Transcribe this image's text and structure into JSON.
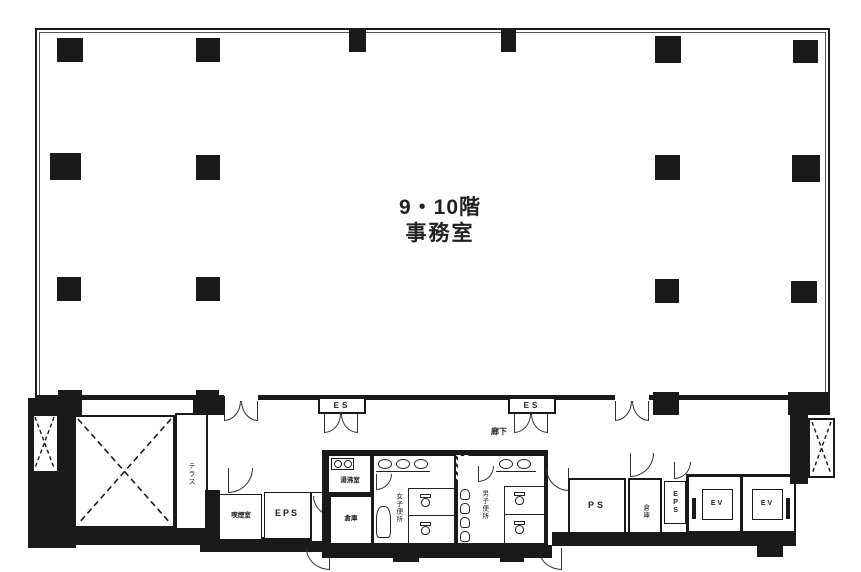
{
  "title": {
    "line1": "9・10階",
    "line2": "事務室"
  },
  "labels": {
    "es_left": "ES",
    "es_right": "ES",
    "corridor": "廊下",
    "terrace": "テラス",
    "smoking_room": "喫煙室",
    "eps_left": "EPS",
    "kitchenette": "湯沸室",
    "storage_left": "倉庫",
    "womens_toilet": "女子便所",
    "mens_toilet": "男子便所",
    "pipe_shaft": "PS",
    "storage_right": "倉庫",
    "eps_right": "EPS",
    "elevator_1": "EV",
    "elevator_2": "EV"
  },
  "colors": {
    "wall": "#1a1a1a",
    "background": "#ffffff"
  }
}
